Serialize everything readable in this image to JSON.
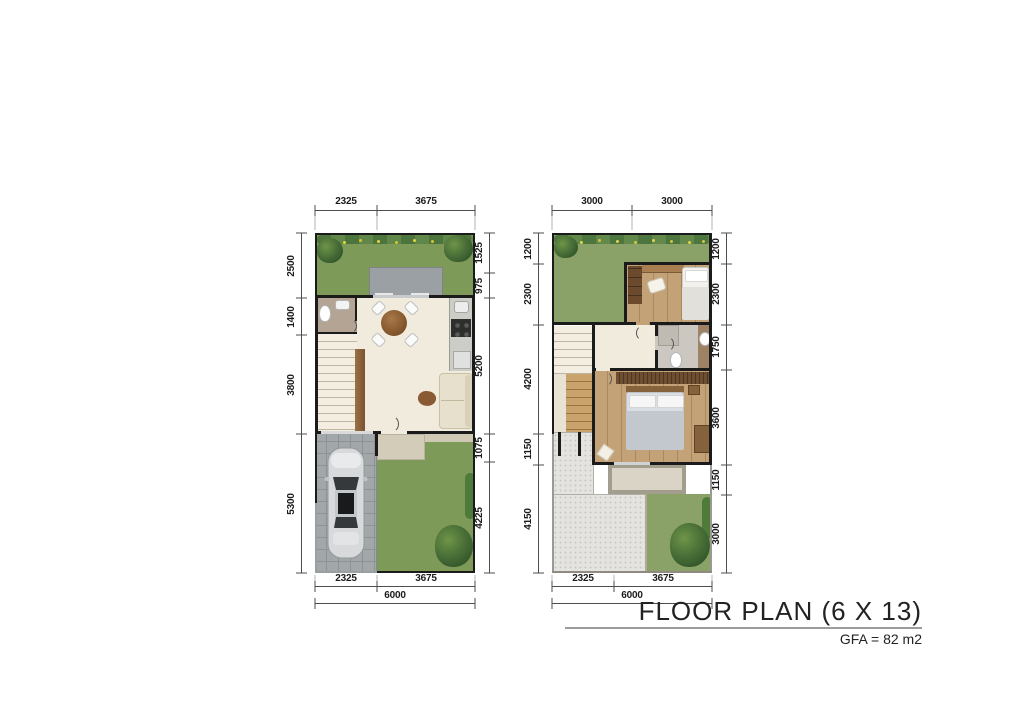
{
  "title_block": {
    "title": "FLOOR PLAN (6 X 13)",
    "subtitle": "GFA = 82 m2"
  },
  "palette": {
    "wall": "#1b1b1b",
    "grass": "#7d9a58",
    "roof_garden_grass": "#8aa268",
    "interior_floor": "#f0ebdd",
    "wood_floor": "#c4a277",
    "gravel_roof": "#e4e3df",
    "deck": "#9aa0a3",
    "dimension_line": "#4d4d4d",
    "flower_yellow": "#e8d43a"
  },
  "ground_floor": {
    "dims_top": [
      "2325",
      "3675"
    ],
    "dims_left": [
      "2500",
      "1400",
      "3800",
      "5300"
    ],
    "dims_right": [
      "1525",
      "975",
      "5200",
      "1075",
      "4225"
    ],
    "dims_bottom": [
      "2325",
      "3675"
    ],
    "dim_total_bottom": "6000"
  },
  "upper_floor": {
    "dims_top": [
      "3000",
      "3000"
    ],
    "dims_left": [
      "1200",
      "2300",
      "4200",
      "1150",
      "4150"
    ],
    "dims_right": [
      "1200",
      "2300",
      "1750",
      "3600",
      "1150",
      "3000"
    ],
    "dims_bottom": [
      "2325",
      "3675"
    ],
    "dim_total_bottom": "6000"
  }
}
